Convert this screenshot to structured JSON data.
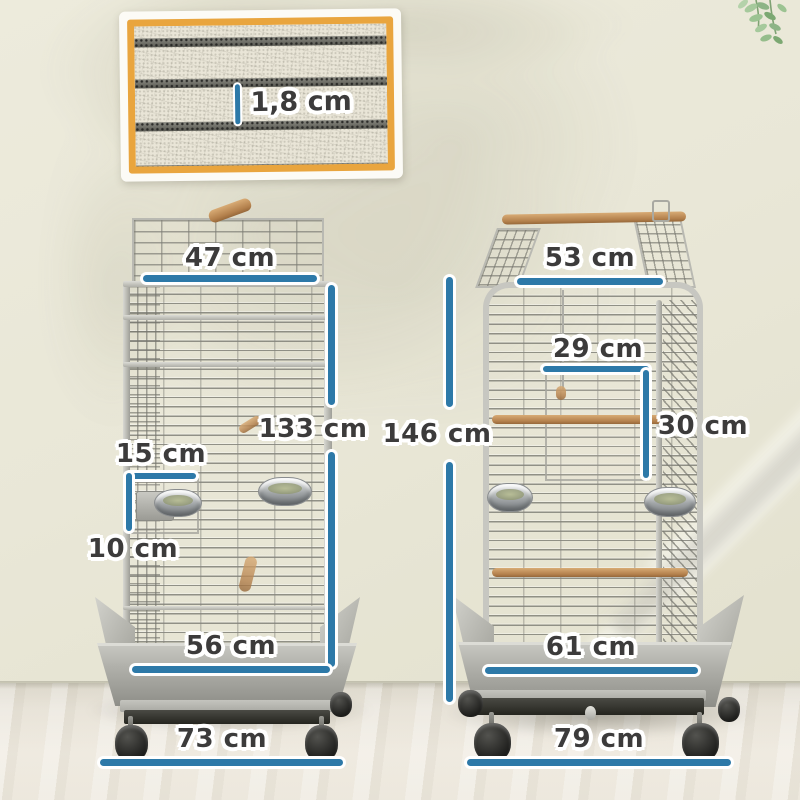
{
  "detail_inset": {
    "wire_spacing": "1,8 cm"
  },
  "cage_left": {
    "top_width": "47 cm",
    "height": "133 cm",
    "door_width": "15 cm",
    "door_height": "10 cm",
    "cage_width": "56 cm",
    "base_width": "73 cm"
  },
  "cage_right": {
    "top_width": "53 cm",
    "height": "146 cm",
    "door_width": "29 cm",
    "door_height": "30 cm",
    "cage_width": "61 cm",
    "base_width": "79 cm"
  },
  "colors": {
    "measure_line": "#2d79a8",
    "label_text": "#3c3b3b",
    "inset_border": "#e9a53e",
    "wall": "#e9e7d7",
    "perch_wood": "#c59a66"
  }
}
